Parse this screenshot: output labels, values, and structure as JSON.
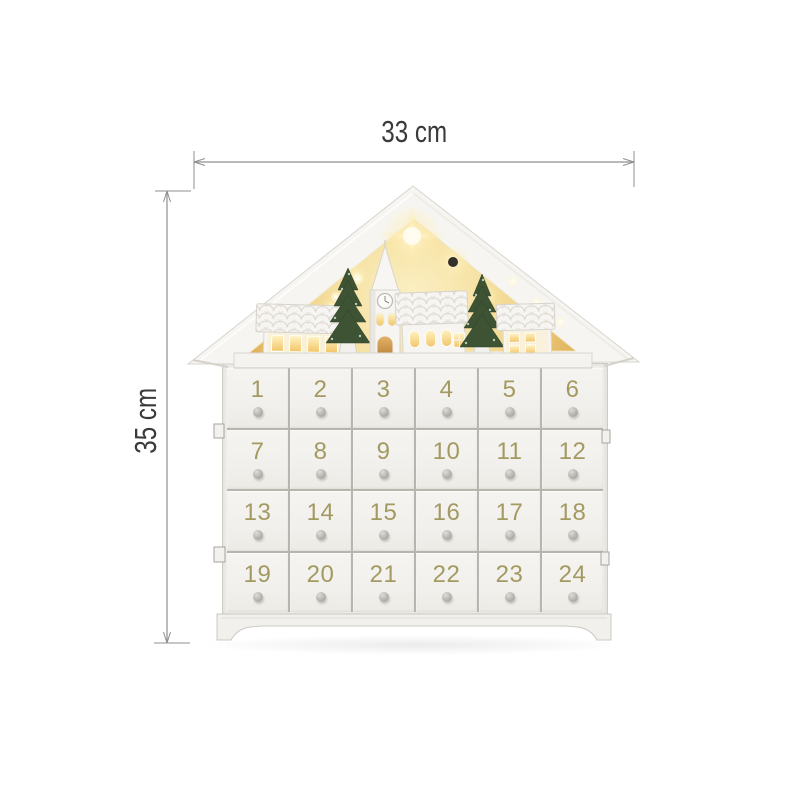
{
  "annotations": {
    "width_label": "33 cm",
    "height_label": "35 cm"
  },
  "calendar": {
    "columns": 6,
    "rows": 4,
    "drawer_numbers": [
      "1",
      "2",
      "3",
      "4",
      "5",
      "6",
      "7",
      "8",
      "9",
      "10",
      "11",
      "12",
      "13",
      "14",
      "15",
      "16",
      "17",
      "18",
      "19",
      "20",
      "21",
      "22",
      "23",
      "24"
    ]
  },
  "scene": {
    "elements": [
      "church-with-clock-tower",
      "village-house-left",
      "village-house-right",
      "pine-tree-left",
      "pine-tree-right",
      "star-glow",
      "led-lights",
      "display-shelf"
    ]
  },
  "colors": {
    "background": "#ffffff",
    "body_white": "#efeee9",
    "divider_gray": "#b8b5af",
    "drawer_number_gold": "#a39a62",
    "knob_gray": "#b7b4ae",
    "glow_warm": "#f5e0a0",
    "glow_deep": "#dfae58",
    "window_light": "#ffe9a8",
    "tree_green": "#3e5334",
    "dimension_line": "#8f8f8f",
    "dimension_text": "#3a3a3a"
  }
}
